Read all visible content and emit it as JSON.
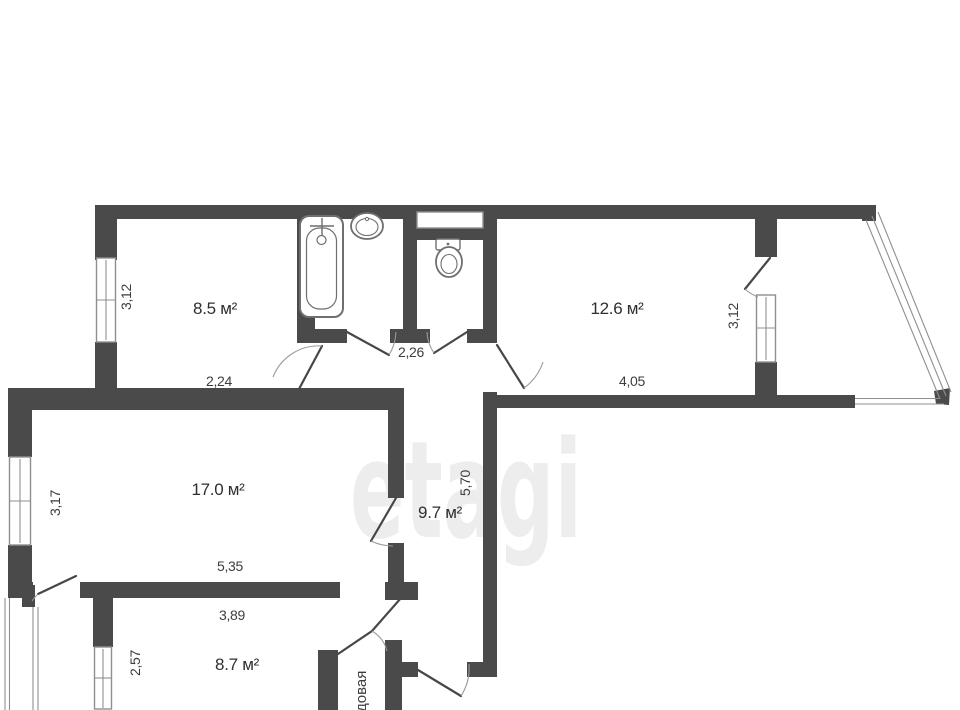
{
  "plan": {
    "watermark": "etagi",
    "rooms": [
      {
        "name": "room-top-left",
        "area": "8.5 м²"
      },
      {
        "name": "room-top-right",
        "area": "12.6 м²"
      },
      {
        "name": "room-living",
        "area": "17.0 м²"
      },
      {
        "name": "hallway",
        "area": "9.7 м²"
      },
      {
        "name": "room-bottom",
        "area": "8.7 м²"
      }
    ],
    "storage_label": "довая",
    "dims": [
      "3,12",
      "2,24",
      "2,26",
      "4,05",
      "3,12",
      "3,17",
      "5,35",
      "5,70",
      "3,89",
      "2,57"
    ],
    "fixtures": [
      "bathtub",
      "sink",
      "toilet"
    ],
    "colors": {
      "wall": "#4a4a4a",
      "window_line": "#8f8f8f",
      "label": "#2f2f2f",
      "watermark": "#ededed",
      "background": "#ffffff"
    }
  }
}
